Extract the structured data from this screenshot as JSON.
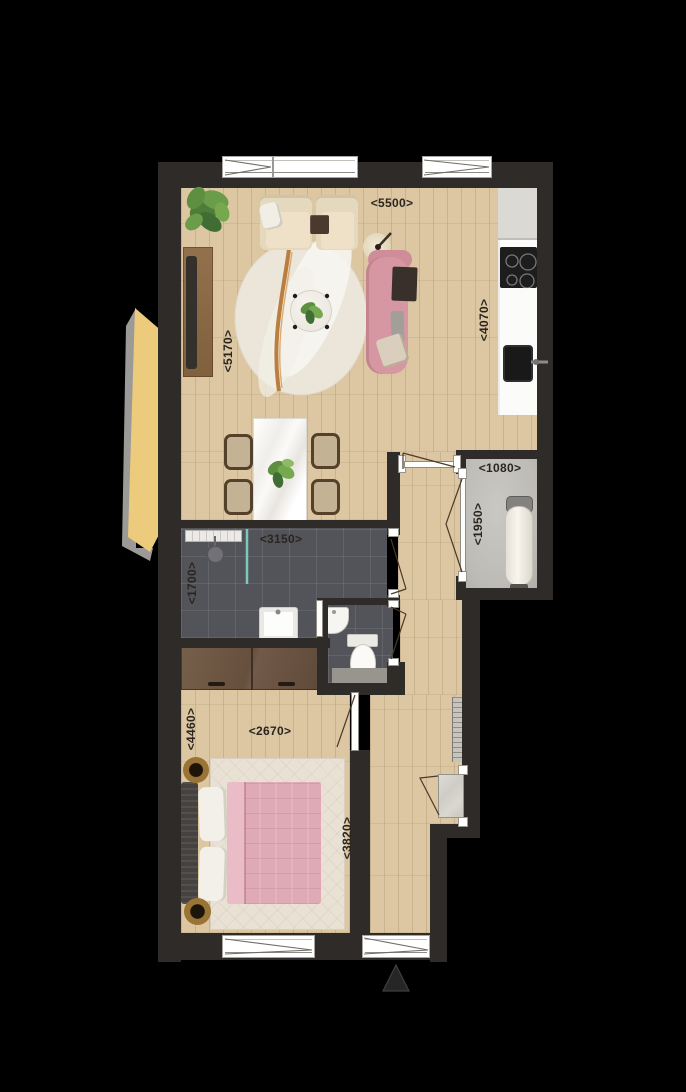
{
  "plan": {
    "type": "apartment-floor-plan",
    "dimensions": {
      "living_width": {
        "text": "<5500>",
        "orientation": "horizontal"
      },
      "living_height": {
        "text": "<5170>",
        "orientation": "vertical"
      },
      "kitchen_wall": {
        "text": "<4070>",
        "orientation": "vertical"
      },
      "storage_width": {
        "text": "<1080>",
        "orientation": "horizontal"
      },
      "storage_depth": {
        "text": "<1950>",
        "orientation": "vertical"
      },
      "bathroom_width": {
        "text": "<3150>",
        "orientation": "horizontal"
      },
      "bathroom_depth": {
        "text": "<1700>",
        "orientation": "vertical"
      },
      "bedroom_width": {
        "text": "<2670>",
        "orientation": "horizontal"
      },
      "bedroom_height": {
        "text": "<4460>",
        "orientation": "vertical"
      },
      "hallway_length": {
        "text": "<3820>",
        "orientation": "vertical"
      }
    },
    "colors": {
      "wall": "#2e2b28",
      "background": "#000000",
      "wood_floor": "#dcc7a2",
      "bathroom_tile": "#53535a",
      "storage_floor": "#c0beb9",
      "accent_pink_sofa": "#d697a2",
      "accent_pink_bed": "#dfa9b6",
      "exterior_wedge_yellow": "#edcb7d",
      "shower_screen_teal": "#7cc9ba",
      "rug_cream": "#ece6da"
    },
    "symbols": {
      "north_arrow": "triangle-up"
    }
  }
}
